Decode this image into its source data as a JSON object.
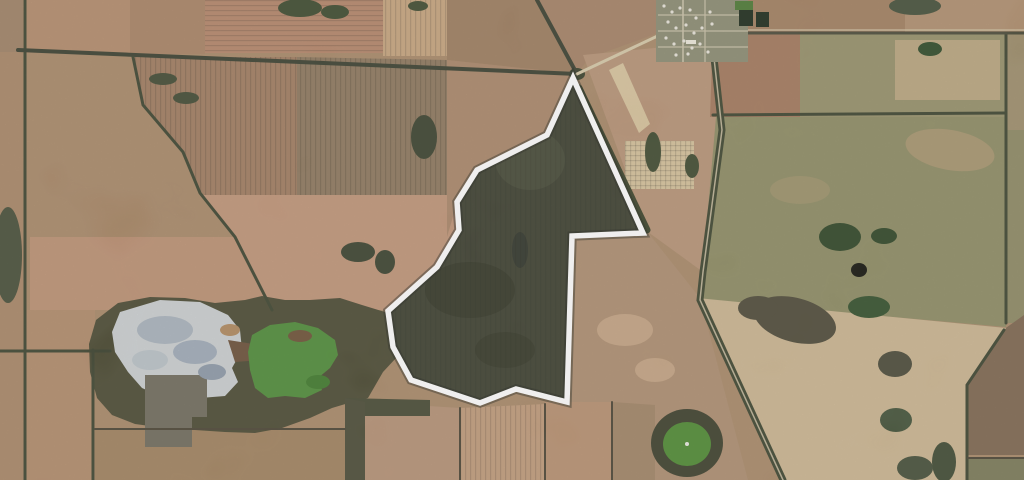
{
  "scene": {
    "canvas": {
      "width": 1024,
      "height": 480,
      "base_color": "#a98969"
    },
    "palette": {
      "boundary_stroke": "#ffffff",
      "parcel_fill": "#3c3f30",
      "treeline": "#3d4430",
      "gravel_road": "#d6c9a8",
      "salt_pan": "#ccd0d2",
      "green_lake": "#4f8c38",
      "pond_green": "#4f8a33"
    },
    "fields": [
      {
        "name": "field-topleft-corner",
        "color": "#9f8166",
        "points": "0,0 23,0 23,52 0,52"
      },
      {
        "name": "field-topleft-a",
        "color": "#b38c6c",
        "points": "23,0 130,0 130,53 23,53"
      },
      {
        "name": "field-topleft-b",
        "color": "#aa8365",
        "points": "130,0 205,0 205,54 130,54"
      },
      {
        "name": "field-top-salmon",
        "color": "#b5866a",
        "stripes": "h",
        "points": "205,0 383,0 383,53 205,53"
      },
      {
        "name": "field-top-wheat",
        "color": "#c7a47e",
        "stripes": "v",
        "points": "383,0 447,0 447,56 383,56"
      },
      {
        "name": "field-top-mid-brown",
        "color": "#9d7d5f",
        "points": "447,0 537,0 577,74 447,60"
      },
      {
        "name": "field-junction-ne",
        "color": "#a58266",
        "points": "537,0 660,0 683,24 589,58 577,74"
      },
      {
        "name": "field-ne-pink",
        "color": "#b79377",
        "points": "583,55 715,42 722,130 703,272 648,232"
      },
      {
        "name": "field-cream-strip",
        "color": "#d8c49e",
        "points": "609,70 623,63 650,124 639,133"
      },
      {
        "name": "field-cream-patch",
        "color": "#d5c19b",
        "stripes": "grid",
        "points": "625,141 694,141 694,189 625,189"
      },
      {
        "name": "field-topright-a",
        "color": "#a27f60",
        "points": "748,0 905,0 905,33 748,33"
      },
      {
        "name": "field-topright-b",
        "color": "#b08f6f",
        "points": "905,0 1024,0 1024,33 905,33"
      },
      {
        "name": "field-rightband-pink",
        "color": "#a3795c",
        "points": "713,33 800,33 800,117 710,117"
      },
      {
        "name": "field-rightband-olive",
        "color": "#97906a",
        "points": "800,33 1006,33 1006,117 800,117"
      },
      {
        "name": "field-rightband-pale",
        "color": "#bfa983",
        "opacity": 0.85,
        "points": "895,40 1000,40 1000,100 895,100"
      },
      {
        "name": "field-right-big-olive",
        "color": "#8e8c64",
        "points": "716,117 1006,117 1006,327 700,300"
      },
      {
        "name": "field-rightcol-top",
        "color": "#9e8e6c",
        "points": "1006,33 1024,33 1024,130 1006,130"
      },
      {
        "name": "field-rightcol-mid",
        "color": "#8e8964",
        "points": "1006,130 1024,130 1024,323 1006,323"
      },
      {
        "name": "field-rightcol-maroon",
        "color": "#7e6750",
        "points": "1003,330 1024,315 1024,455 968,455 968,385"
      },
      {
        "name": "field-rightcol-green",
        "color": "#7a7a58",
        "points": "968,458 1024,458 1024,480 968,480"
      },
      {
        "name": "field-se-of-parcel",
        "color": "#ae8e70",
        "points": "570,232 646,230 700,298 748,480 558,480"
      },
      {
        "name": "field-cream-bottom",
        "color": "#cbb591",
        "points": "697,298 1006,328 967,385 967,480 783,480"
      },
      {
        "name": "field-belowparcel-a",
        "color": "#b59176",
        "points": "365,402 460,408 460,480 365,480"
      },
      {
        "name": "field-belowparcel-b",
        "color": "#c09b7b",
        "stripes": "v",
        "points": "460,408 545,404 545,480 460,480"
      },
      {
        "name": "field-belowparcel-c",
        "color": "#b79070",
        "points": "545,402 612,402 612,480 545,480"
      },
      {
        "name": "field-belowparcel-d",
        "color": "#a08466",
        "points": "612,402 655,405 655,480 612,480"
      },
      {
        "name": "field-left-strip",
        "color": "#a98768",
        "points": "0,52 23,52 23,480 0,480"
      },
      {
        "name": "field-bottomleft-a",
        "color": "#b18b6b",
        "points": "23,310 95,310 95,480 23,480"
      },
      {
        "name": "field-bottomleft-b",
        "color": "#a1825f",
        "points": "95,430 347,430 347,480 95,480"
      },
      {
        "name": "field-brown-left",
        "color": "#a07c60",
        "stripes": "v",
        "points": "133,57 297,57 297,195 200,195 183,152 143,105"
      },
      {
        "name": "field-brown-right",
        "color": "#8d775d",
        "stripes": "v",
        "points": "297,57 447,60 447,195 297,195"
      },
      {
        "name": "field-salmon-left",
        "color": "#bd9174",
        "points": "30,237 235,237 272,310 30,310"
      },
      {
        "name": "field-salmon-right",
        "color": "#c09478",
        "points": "200,195 460,195 460,310 272,310 235,237"
      },
      {
        "name": "field-nw-of-parcel",
        "color": "#ab876a",
        "points": "447,60 577,74 547,136 477,170 457,203 447,237"
      }
    ],
    "polys": [
      {
        "name": "vegetation-band",
        "color": "#4b4a33",
        "points": "96,320 118,303 150,297 185,298 215,303 245,300 262,296 285,300 310,300 340,298 362,305 385,312 397,332 396,358 383,372 368,398 352,402 332,408 310,418 282,428 255,433 225,432 195,430 165,428 135,424 112,415 97,398 90,372 89,344"
      },
      {
        "name": "belowparcel-veg-strip",
        "color": "#474a34",
        "points": "345,398 430,400 430,416 345,416"
      },
      {
        "name": "dark-strip-347",
        "color": "#4b4b36",
        "points": "345,398 365,402 365,480 345,480"
      },
      {
        "name": "salt-lake",
        "color": "#ccd0d2",
        "points": "120,312 160,300 200,302 228,315 240,330 242,350 232,368 238,382 225,396 200,398 178,390 160,396 142,388 128,372 115,352 112,332"
      },
      {
        "name": "salt-lake-neck",
        "color": "#6b5038",
        "points": "228,340 260,345 262,360 235,362"
      },
      {
        "name": "green-lake",
        "color": "#4f8c38",
        "points": "252,335 270,325 295,322 318,328 335,340 338,355 330,368 318,378 322,390 305,398 285,396 268,398 255,388 250,370 248,352"
      },
      {
        "name": "dark-gray-field",
        "color": "#6f6b5c",
        "points": "145,375 207,375 207,417 192,417 192,447 145,447"
      }
    ],
    "patches": [
      {
        "name": "top-trees-1",
        "color": "#3c4a2f",
        "cx": 300,
        "cy": 8,
        "rx": 22,
        "ry": 9
      },
      {
        "name": "top-trees-2",
        "color": "#3c4a2f",
        "cx": 335,
        "cy": 12,
        "rx": 14,
        "ry": 7
      },
      {
        "name": "topright-trees",
        "color": "#45503a",
        "cx": 915,
        "cy": 6,
        "rx": 26,
        "ry": 9
      },
      {
        "name": "wheat-scrub",
        "color": "#3f4a30",
        "cx": 418,
        "cy": 6,
        "rx": 10,
        "ry": 5
      },
      {
        "name": "nw-scrub-1",
        "color": "#414a33",
        "cx": 163,
        "cy": 79,
        "rx": 14,
        "ry": 6
      },
      {
        "name": "nw-scrub-2",
        "color": "#414a33",
        "cx": 186,
        "cy": 98,
        "rx": 13,
        "ry": 6
      },
      {
        "name": "parcelleft-scrub-top",
        "color": "#3a422e",
        "cx": 424,
        "cy": 137,
        "rx": 13,
        "ry": 22
      },
      {
        "name": "parcelleft-scrub-1",
        "color": "#3a422e",
        "cx": 358,
        "cy": 252,
        "rx": 17,
        "ry": 10
      },
      {
        "name": "parcelleft-scrub-2",
        "color": "#3a422e",
        "cx": 385,
        "cy": 262,
        "rx": 10,
        "ry": 12
      },
      {
        "name": "left-edge-scrub",
        "color": "#474f38",
        "cx": 8,
        "cy": 255,
        "rx": 14,
        "ry": 48
      },
      {
        "name": "ne-scrub-1",
        "color": "#3f4a30",
        "cx": 653,
        "cy": 152,
        "rx": 8,
        "ry": 20
      },
      {
        "name": "ne-scrub-2",
        "color": "#3f4a30",
        "cx": 692,
        "cy": 166,
        "rx": 7,
        "ry": 12
      },
      {
        "name": "junction-trees",
        "color": "#3a422c",
        "cx": 577,
        "cy": 74,
        "rx": 8,
        "ry": 6
      },
      {
        "name": "olive-pond-1",
        "color": "#2e4526",
        "cx": 840,
        "cy": 237,
        "rx": 21,
        "ry": 14
      },
      {
        "name": "olive-pond-2",
        "color": "#2e4526",
        "cx": 884,
        "cy": 236,
        "rx": 13,
        "ry": 8
      },
      {
        "name": "black-pond",
        "color": "#14140e",
        "cx": 859,
        "cy": 270,
        "rx": 8,
        "ry": 7
      },
      {
        "name": "olive-green-patch",
        "color": "#33502c",
        "cx": 869,
        "cy": 307,
        "rx": 21,
        "ry": 11
      },
      {
        "name": "rightband-pond",
        "color": "#2e4a28",
        "cx": 930,
        "cy": 49,
        "rx": 12,
        "ry": 7
      },
      {
        "name": "olive-pale-1",
        "color": "#b59a74",
        "cx": 950,
        "cy": 150,
        "rx": 45,
        "ry": 20,
        "rot": 10,
        "opacity": 0.6
      },
      {
        "name": "olive-pale-2",
        "color": "#a5946e",
        "cx": 800,
        "cy": 190,
        "rx": 30,
        "ry": 14,
        "opacity": 0.6
      },
      {
        "name": "cream-smudge-1",
        "color": "#4e4a38",
        "cx": 795,
        "cy": 320,
        "rx": 42,
        "ry": 22,
        "rot": 15
      },
      {
        "name": "cream-smudge-2",
        "color": "#4e4a38",
        "cx": 758,
        "cy": 308,
        "rx": 20,
        "ry": 12
      },
      {
        "name": "cream-blob-3",
        "color": "#4a4a38",
        "cx": 895,
        "cy": 364,
        "rx": 17,
        "ry": 13
      },
      {
        "name": "cream-blob-4",
        "color": "#435238",
        "cx": 896,
        "cy": 420,
        "rx": 16,
        "ry": 12
      },
      {
        "name": "cream-squiggle",
        "color": "#3f4a33",
        "cx": 944,
        "cy": 462,
        "rx": 12,
        "ry": 20
      },
      {
        "name": "cream-bl-dark",
        "color": "#454f38",
        "cx": 915,
        "cy": 468,
        "rx": 18,
        "ry": 12
      },
      {
        "name": "salt-mottle-1",
        "color": "#a9b3bd",
        "cx": 165,
        "cy": 330,
        "rx": 28,
        "ry": 14
      },
      {
        "name": "salt-mottle-2",
        "color": "#9fabb8",
        "cx": 195,
        "cy": 352,
        "rx": 22,
        "ry": 12
      },
      {
        "name": "salt-mottle-3",
        "color": "#b9c2c8",
        "cx": 150,
        "cy": 360,
        "rx": 18,
        "ry": 10
      },
      {
        "name": "salt-mottle-4",
        "color": "#8e9aa8",
        "cx": 212,
        "cy": 372,
        "rx": 14,
        "ry": 8
      },
      {
        "name": "salt-rim",
        "color": "#b0895f",
        "cx": 230,
        "cy": 330,
        "rx": 10,
        "ry": 6
      },
      {
        "name": "greenlake-shade",
        "color": "#3f7a2c",
        "cx": 318,
        "cy": 382,
        "rx": 12,
        "ry": 7
      },
      {
        "name": "greenlake-brown",
        "color": "#6d5136",
        "cx": 300,
        "cy": 336,
        "rx": 12,
        "ry": 6
      },
      {
        "name": "se-pale-1",
        "color": "#c9a988",
        "cx": 625,
        "cy": 330,
        "rx": 28,
        "ry": 16,
        "opacity": 0.8
      },
      {
        "name": "se-pale-2",
        "color": "#c9a988",
        "cx": 655,
        "cy": 370,
        "rx": 20,
        "ry": 12,
        "opacity": 0.8
      },
      {
        "name": "pond-ring",
        "color": "#3c3f2c",
        "cx": 687,
        "cy": 443,
        "rx": 36,
        "ry": 34
      },
      {
        "name": "pond-green",
        "color": "#4f8a33",
        "cx": 687,
        "cy": 444,
        "rx": 24,
        "ry": 22
      },
      {
        "name": "pond-dot",
        "color": "#e8e8e0",
        "cx": 687,
        "cy": 444,
        "rx": 2,
        "ry": 2
      }
    ],
    "treelines": [
      {
        "name": "treeline-left-vertical",
        "color": "#3d4430",
        "width": 3,
        "points": "25,0 25,52 25,310 25,480"
      },
      {
        "name": "treeline-road-west-east",
        "color": "#3a4030",
        "width": 4,
        "points": "18,50 300,62 577,74"
      },
      {
        "name": "treeline-diagonal-nw",
        "color": "#3d4430",
        "width": 3,
        "points": "133,57 143,105 183,152 200,193 235,237 272,310"
      },
      {
        "name": "road-north-vertical",
        "color": "#3a4030",
        "width": 4,
        "points": "537,0 577,74"
      },
      {
        "name": "treeline-bl-horizontal",
        "color": "#3d4430",
        "width": 3,
        "points": "0,351 110,351"
      },
      {
        "name": "treeline-bl-vertical",
        "color": "#3d4430",
        "width": 3,
        "points": "93,350 93,480"
      },
      {
        "name": "treeline-bl-428",
        "color": "#4a4434",
        "width": 2,
        "points": "95,429 345,429"
      },
      {
        "name": "treeline-tr-horizontal",
        "color": "#3d4430",
        "width": 3,
        "points": "713,115 1006,113"
      },
      {
        "name": "treeline-tr-vertical",
        "color": "#3d4430",
        "width": 3,
        "points": "1006,33 1006,323"
      },
      {
        "name": "treeline-tr-diagonal",
        "color": "#3d4430",
        "width": 3,
        "points": "1004,330 967,385 967,480"
      },
      {
        "name": "boundary-strip-460",
        "color": "#4a4434",
        "width": 2,
        "points": "460,408 460,480"
      },
      {
        "name": "boundary-strip-545",
        "color": "#4a4434",
        "width": 2,
        "points": "545,404 545,480"
      },
      {
        "name": "boundary-strip-612",
        "color": "#4a4434",
        "width": 2,
        "points": "612,402 612,480"
      },
      {
        "name": "treeline-se-458",
        "color": "#4a4434",
        "width": 2,
        "points": "968,458 1024,458"
      },
      {
        "name": "road-diagonal-band",
        "color": "#3e4530",
        "width": 7,
        "points": "712,40 722,130 703,272 700,300 783,480"
      }
    ],
    "roads": [
      {
        "name": "gravel-road-to-town",
        "color": "#d6c9a8",
        "width": 3,
        "points": "577,74 683,24 690,0"
      },
      {
        "name": "road-diagonal-centerline",
        "color": "#cfc2a4",
        "width": 1.5,
        "opacity": 0.85,
        "points": "712,40 722,130 703,272 700,300 783,480"
      },
      {
        "name": "road-topright-dark",
        "color": "#4a4a38",
        "width": 3,
        "points": "745,33 1024,33"
      },
      {
        "name": "road-topright-light",
        "color": "#cfc0a0",
        "width": 1.2,
        "points": "748,30 1024,30"
      }
    ],
    "town": {
      "name": "township",
      "base": {
        "x": 656,
        "y": 0,
        "w": 92,
        "h": 62,
        "color": "#8b8b72"
      },
      "streets": [
        {
          "points": "683,0 683,62",
          "color": "#c9c0a8",
          "width": 2
        },
        {
          "points": "705,0 705,62",
          "color": "#c9c0a8",
          "width": 1.5
        },
        {
          "points": "658,15 748,15",
          "color": "#c9c0a8",
          "width": 1.5
        },
        {
          "points": "658,31 748,31",
          "color": "#c9c0a8",
          "width": 1.5
        },
        {
          "points": "658,47 748,47",
          "color": "#c9c0a8",
          "width": 1.5
        }
      ],
      "blocks": [
        {
          "x": 739,
          "y": 7,
          "w": 14,
          "h": 19,
          "color": "#1d2b1b"
        },
        {
          "x": 756,
          "y": 12,
          "w": 13,
          "h": 15,
          "color": "#1d2b1b"
        },
        {
          "x": 735,
          "y": 1,
          "w": 18,
          "h": 9,
          "color": "#4c7a34"
        },
        {
          "x": 686,
          "y": 40,
          "w": 10,
          "h": 4,
          "color": "#ece8dc"
        }
      ],
      "houses": [
        {
          "x": 664,
          "y": 6
        },
        {
          "x": 672,
          "y": 12
        },
        {
          "x": 680,
          "y": 8
        },
        {
          "x": 690,
          "y": 10
        },
        {
          "x": 696,
          "y": 18
        },
        {
          "x": 668,
          "y": 22
        },
        {
          "x": 676,
          "y": 28
        },
        {
          "x": 686,
          "y": 25
        },
        {
          "x": 694,
          "y": 33
        },
        {
          "x": 702,
          "y": 28
        },
        {
          "x": 666,
          "y": 38
        },
        {
          "x": 674,
          "y": 44
        },
        {
          "x": 684,
          "y": 41
        },
        {
          "x": 692,
          "y": 48
        },
        {
          "x": 700,
          "y": 44
        },
        {
          "x": 710,
          "y": 12
        },
        {
          "x": 712,
          "y": 24
        },
        {
          "x": 708,
          "y": 52
        },
        {
          "x": 676,
          "y": 55
        },
        {
          "x": 688,
          "y": 54
        }
      ],
      "house_color": "#e8e4da"
    },
    "parcel": {
      "name": "highlighted-property-parcel",
      "points": "573,78 643,233 572,236 567,402 516,389 480,403 411,380 393,347 388,311 437,267 459,230 457,202 477,170 547,135",
      "fill": "#3c3f30",
      "stroke": "#ffffff",
      "stroke_width": 5.5,
      "casing": {
        "color": "#23261c",
        "width": 9.5,
        "opacity": 0.45
      },
      "windbreak": {
        "points": "579,88 647,230",
        "color": "#3a4229",
        "width": 7
      },
      "blotches": [
        {
          "cx": 470,
          "cy": 290,
          "rx": 45,
          "ry": 28,
          "color": "#343727"
        },
        {
          "cx": 530,
          "cy": 160,
          "rx": 35,
          "ry": 30,
          "color": "#454836"
        },
        {
          "cx": 505,
          "cy": 350,
          "rx": 30,
          "ry": 18,
          "color": "#353828"
        },
        {
          "cx": 435,
          "cy": 215,
          "rx": 10,
          "ry": 14,
          "color": "#4a4e3a"
        },
        {
          "cx": 520,
          "cy": 250,
          "rx": 8,
          "ry": 18,
          "color": "#30342a"
        }
      ]
    }
  }
}
